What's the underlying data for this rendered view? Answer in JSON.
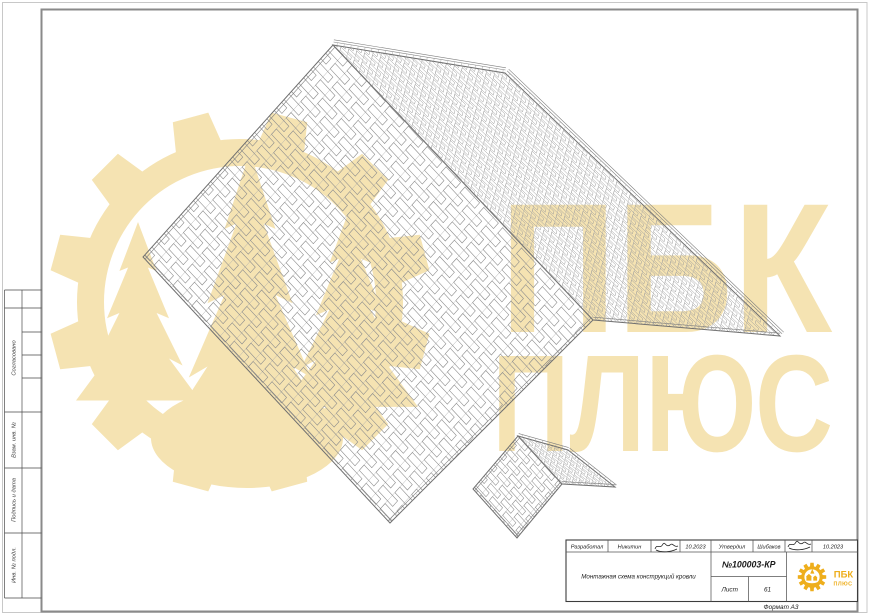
{
  "sheet": {
    "format_label": "Формат А3"
  },
  "watermark": {
    "line1": "ПБК",
    "line2": "ПЛЮС"
  },
  "side_strip": {
    "labels": [
      "Согласовано",
      "Взам. инв. №",
      "Подпись и дата",
      "Инв. № подл."
    ]
  },
  "title_block": {
    "developed_label": "Разработал",
    "developed_name": "Никитин",
    "developed_date": "10.2023",
    "approved_label": "Утвердил",
    "approved_name": "Шибаков",
    "approved_date": "10.2023",
    "drawing_title": "Монтажная схема конструкций кровли",
    "doc_number": "№100003-КР",
    "sheet_label": "Лист",
    "sheet_number": "61",
    "logo_brand": "ПБК",
    "logo_sub": "ПЛЮС"
  },
  "colors": {
    "watermark": "#f5e3b2",
    "logo_gold": "#eeae1c",
    "frame_gray": "#8a8a8a",
    "outer_border": "#c8c8c8",
    "stamp_line": "#3d3d3d"
  }
}
